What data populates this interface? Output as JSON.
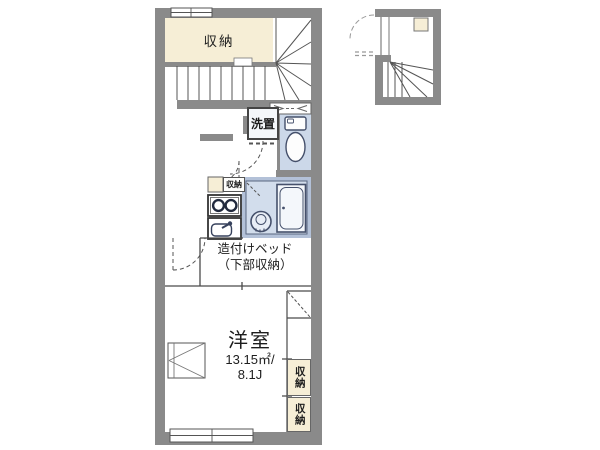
{
  "title": "apartment-floor-plan",
  "colors": {
    "wall": "#8a8a8a",
    "cream": "#f6eed6",
    "blue": "#ccd8e9",
    "bath_surround": "#b3c1d8",
    "bath_floor": "#d2ddec",
    "line_dark": "#4a4a4a",
    "fixture": "#36415c"
  },
  "rooms": {
    "storage_top": {
      "label": "収納"
    },
    "laundry": {
      "label": "洗置"
    },
    "kitchen_storage": {
      "label": "収納"
    },
    "bed": {
      "label_line1": "造付けベッド",
      "label_line2": "（下部収納）"
    },
    "main_room": {
      "name": "洋室",
      "area_sqm": "13.15㎡/",
      "area_jo": "8.1J"
    },
    "closet_right_upper": {
      "label": "収納"
    },
    "closet_right_lower": {
      "label": "収納"
    }
  }
}
